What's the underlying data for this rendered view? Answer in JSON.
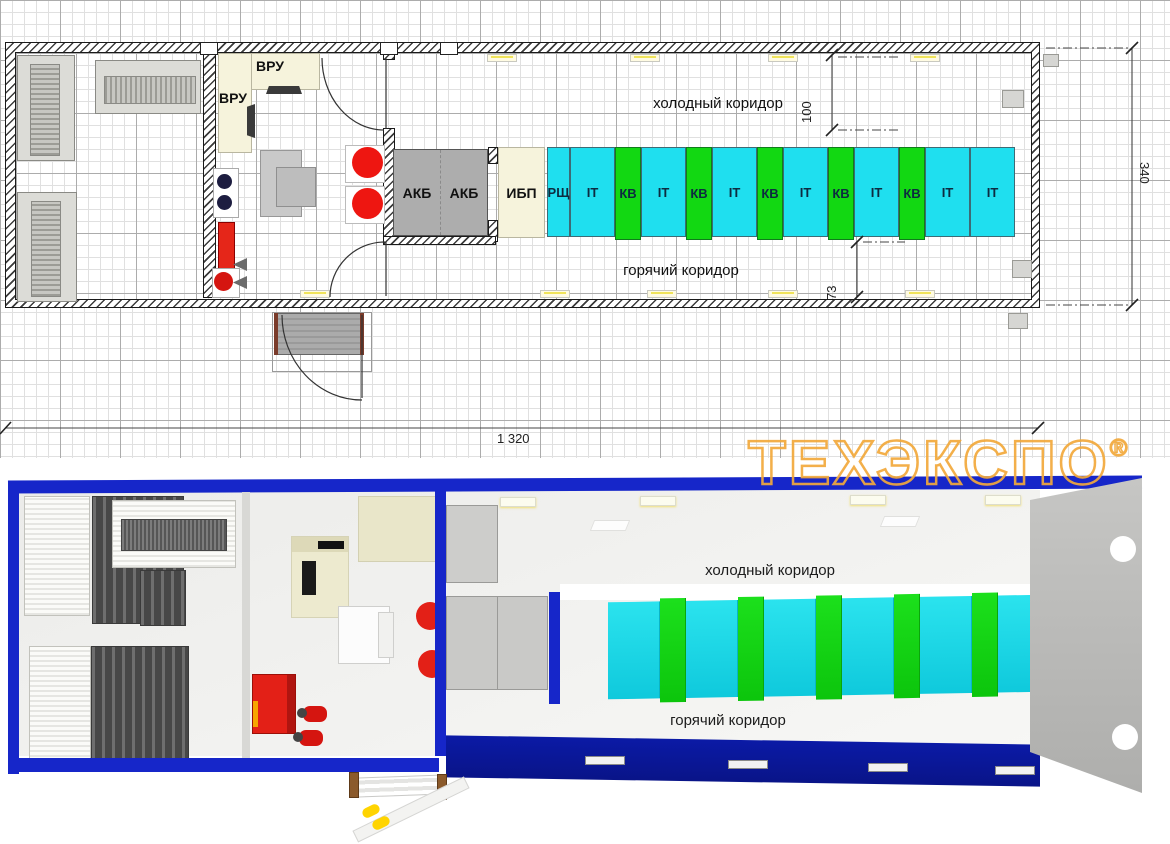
{
  "plan2d": {
    "rooms": {
      "vru_label_1": "ВРУ",
      "vru_label_2": "ВРУ",
      "akb_label_1": "АКБ",
      "akb_label_2": "АКБ",
      "ups_label": "ИБП",
      "cold_corridor": "холодный коридор",
      "hot_corridor": "горячий коридор"
    },
    "racks": [
      {
        "label": "РЩ",
        "type": "switchboard"
      },
      {
        "label": "IT",
        "type": "it"
      },
      {
        "label": "КВ",
        "type": "cooling"
      },
      {
        "label": "IT",
        "type": "it"
      },
      {
        "label": "КВ",
        "type": "cooling"
      },
      {
        "label": "IT",
        "type": "it"
      },
      {
        "label": "КВ",
        "type": "cooling"
      },
      {
        "label": "IT",
        "type": "it"
      },
      {
        "label": "КВ",
        "type": "cooling"
      },
      {
        "label": "IT",
        "type": "it"
      },
      {
        "label": "КВ",
        "type": "cooling"
      },
      {
        "label": "IT",
        "type": "it"
      },
      {
        "label": "IT",
        "type": "it"
      }
    ],
    "dimensions": {
      "overall_length": "1 320",
      "overall_depth": "340",
      "cold_corridor_width": "100",
      "hot_corridor_width": "73"
    }
  },
  "view3d": {
    "cold_corridor": "холодный коридор",
    "hot_corridor": "горячий коридор"
  },
  "watermark": {
    "text": "ТЕХЭКСПО",
    "registered_mark": "®"
  },
  "colors": {
    "container_blue": "#1626C9",
    "floor_blue": "#0A17A0",
    "it_rack_cyan": "#1FDFEF",
    "cooling_rack_green": "#12D812",
    "cabinet_cream": "#F6F3DC",
    "equipment_gray": "#ADADAD",
    "alarm_red": "#E52619",
    "watermark_orange": "#F2A93B"
  }
}
